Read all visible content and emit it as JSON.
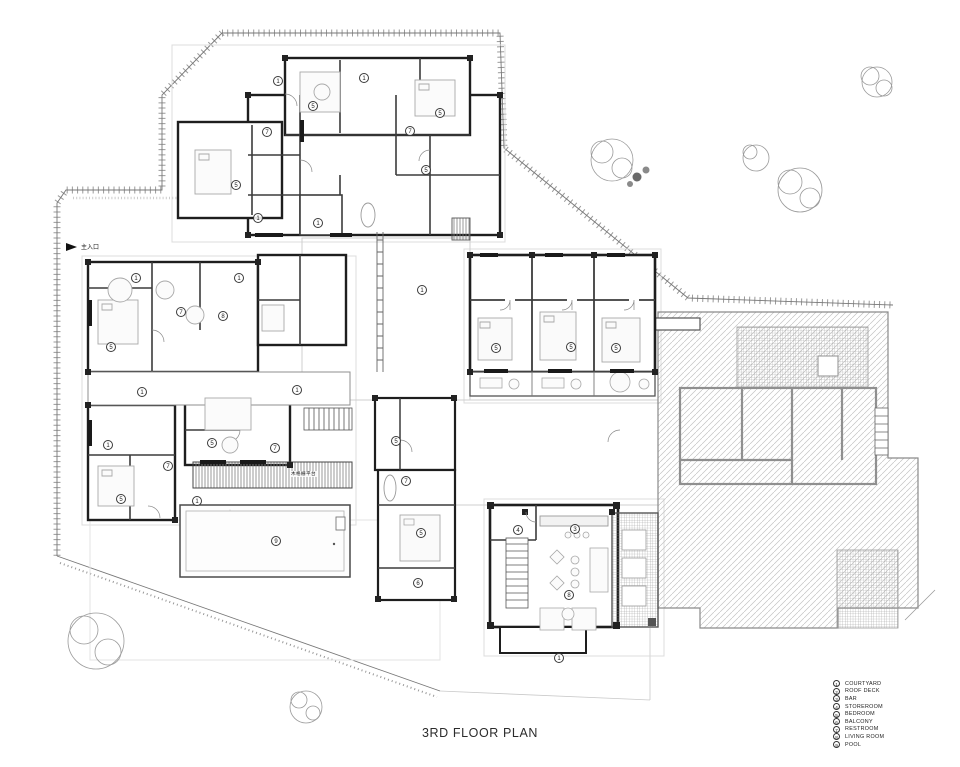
{
  "title": "3RD FLOOR PLAN",
  "entrance": {
    "label": "主入口",
    "icon": "arrow-right"
  },
  "louver_label": "木格栅平台",
  "legend": {
    "items": [
      {
        "num": "1",
        "label": "COURTYARD"
      },
      {
        "num": "2",
        "label": "ROOF DECK"
      },
      {
        "num": "3",
        "label": "BAR"
      },
      {
        "num": "4",
        "label": "STOREROOM"
      },
      {
        "num": "5",
        "label": "BEDROOM"
      },
      {
        "num": "6",
        "label": "BALCONY"
      },
      {
        "num": "7",
        "label": "RESTROOM"
      },
      {
        "num": "8",
        "label": "LIVING ROOM"
      },
      {
        "num": "9",
        "label": "POOL"
      }
    ]
  },
  "room_markers": [
    {
      "n": "1",
      "x": 278,
      "y": 81
    },
    {
      "n": "5",
      "x": 313,
      "y": 106
    },
    {
      "n": "1",
      "x": 364,
      "y": 78
    },
    {
      "n": "5",
      "x": 440,
      "y": 113
    },
    {
      "n": "7",
      "x": 267,
      "y": 132
    },
    {
      "n": "7",
      "x": 410,
      "y": 131
    },
    {
      "n": "5",
      "x": 236,
      "y": 185
    },
    {
      "n": "5",
      "x": 426,
      "y": 170
    },
    {
      "n": "1",
      "x": 258,
      "y": 218
    },
    {
      "n": "1",
      "x": 318,
      "y": 223
    },
    {
      "n": "1",
      "x": 136,
      "y": 278
    },
    {
      "n": "1",
      "x": 239,
      "y": 278
    },
    {
      "n": "7",
      "x": 181,
      "y": 312
    },
    {
      "n": "8",
      "x": 223,
      "y": 316
    },
    {
      "n": "5",
      "x": 111,
      "y": 347
    },
    {
      "n": "1",
      "x": 422,
      "y": 290
    },
    {
      "n": "1",
      "x": 142,
      "y": 392
    },
    {
      "n": "1",
      "x": 297,
      "y": 390
    },
    {
      "n": "5",
      "x": 212,
      "y": 443
    },
    {
      "n": "1",
      "x": 108,
      "y": 445
    },
    {
      "n": "7",
      "x": 168,
      "y": 466
    },
    {
      "n": "7",
      "x": 275,
      "y": 448
    },
    {
      "n": "5",
      "x": 121,
      "y": 499
    },
    {
      "n": "1",
      "x": 197,
      "y": 501
    },
    {
      "n": "5",
      "x": 496,
      "y": 348
    },
    {
      "n": "5",
      "x": 571,
      "y": 347
    },
    {
      "n": "5",
      "x": 616,
      "y": 348
    },
    {
      "n": "5",
      "x": 396,
      "y": 441
    },
    {
      "n": "7",
      "x": 406,
      "y": 481
    },
    {
      "n": "5",
      "x": 421,
      "y": 533
    },
    {
      "n": "6",
      "x": 418,
      "y": 583
    },
    {
      "n": "4",
      "x": 518,
      "y": 530
    },
    {
      "n": "3",
      "x": 575,
      "y": 529
    },
    {
      "n": "8",
      "x": 569,
      "y": 595
    },
    {
      "n": "1",
      "x": 559,
      "y": 658
    },
    {
      "n": "9",
      "x": 276,
      "y": 541
    }
  ],
  "colors": {
    "wall": "#1e1e1e",
    "partition": "#3c3c3c",
    "hatch": "#c4c4c4",
    "ghost": "#8f8f8f",
    "faint": "#dcdcdc"
  }
}
